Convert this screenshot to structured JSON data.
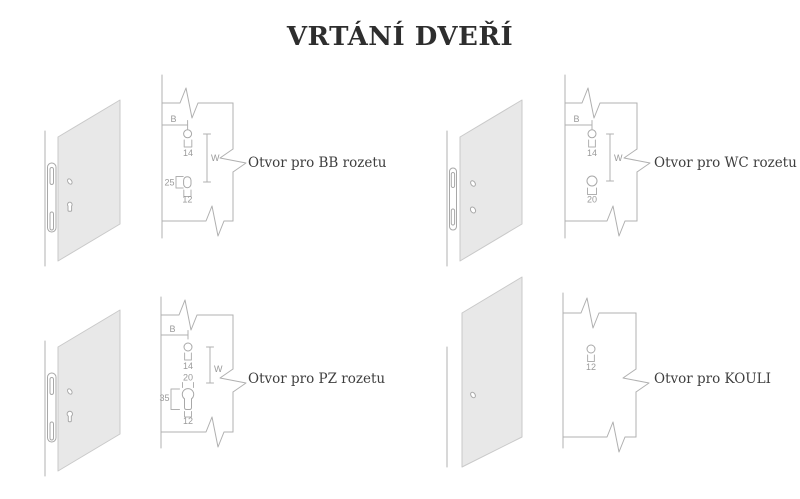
{
  "title": "VRTÁNÍ DVEŘÍ",
  "colors": {
    "background": "#ffffff",
    "title_text": "#2e2e2e",
    "label_text": "#3e3e3e",
    "drawing_line": "#b0b0b0",
    "dimension_text": "#9a9a9a",
    "door_fill": "#e8e8e8",
    "door_edge": "#c9c9c9"
  },
  "diagrams": [
    {
      "name": "BB",
      "label": "Otvor pro BB rozetu",
      "dim_b": "B",
      "dim_w": "W",
      "top_hole_diameter": "14",
      "slot_height": "25",
      "slot_width": "12"
    },
    {
      "name": "WC",
      "label": "Otvor pro WC rozetu",
      "dim_b": "B",
      "dim_w": "W",
      "top_hole_diameter": "14",
      "bottom_hole_diameter": "20"
    },
    {
      "name": "PZ",
      "label": "Otvor pro PZ rozetu",
      "dim_b": "B",
      "dim_w": "W",
      "top_hole_diameter": "14",
      "cylinder_top_width": "20",
      "cylinder_height": "35",
      "cylinder_bottom_width": "12"
    },
    {
      "name": "KOULI",
      "label": "Otvor pro KOULI",
      "hole_diameter": "12"
    }
  ]
}
